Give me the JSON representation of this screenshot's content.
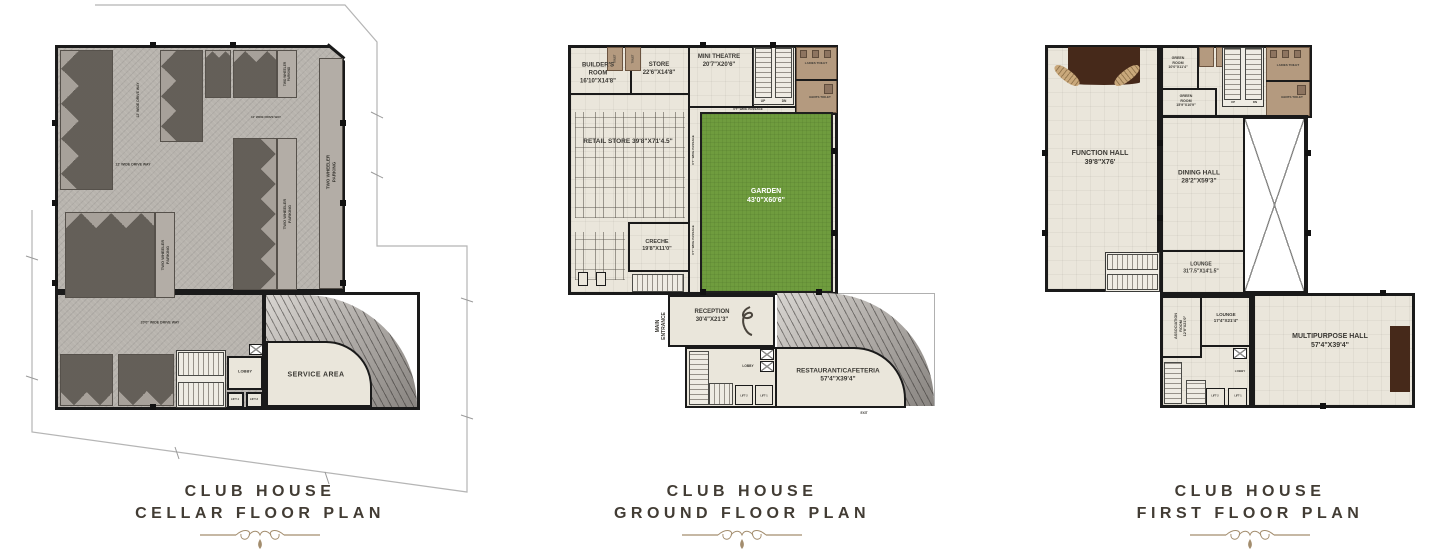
{
  "colors": {
    "garden_green": "#6f9c3e",
    "stage_brown": "#46291a",
    "toilet_tan": "#b49a7f",
    "wall_black": "#1a1a1a",
    "title_text": "#423c34",
    "ornament_tan": "#a38d6e"
  },
  "cellar": {
    "title1": "CLUB HOUSE",
    "title2": "CELLAR FLOOR PLAN",
    "labels": {
      "two_wheeler": "TWO WHEELER\nPARKING",
      "drive12": "12' WIDE DRIVE WAY",
      "drive20": "20'0\" WIDE DRIVE WAY",
      "service": "SERVICE AREA",
      "lobby": "LOBBY",
      "lift1": "LIFT-1",
      "lift2": "LIFT-2"
    }
  },
  "ground": {
    "title1": "CLUB HOUSE",
    "title2": "GROUND FLOOR PLAN",
    "rooms": {
      "builders": "BUILDER'S\nROOM\n16'10\"X14'8\"",
      "store": "STORE\n22'6\"X14'8\"",
      "mini_theatre": "MINI THEATRE\n20'7\"X20'6\"",
      "retail": "RETAIL STORE 39'8\"X71'4.5\"",
      "creche": "CRECHE\n19'8\"X11'0\"",
      "garden": "GARDEN\n43'0\"X60'6\"",
      "reception": "RECEPTION\n30'4\"X21'3\"",
      "restaurant": "RESTAURANT/CAFETERIA\n57'4\"X39'4\"",
      "main_entrance": "MAIN\nENTRANCE",
      "ladies": "LADIES TOILET",
      "gents": "GENTS TOILET",
      "toilet": "TOILET",
      "passage": "6'7\" WIDE PASSAGE",
      "lobby": "LOBBY",
      "lift1": "LIFT-1",
      "lift2": "LIFT-2",
      "up": "UP",
      "dn": "DN",
      "exit": "EXIT"
    }
  },
  "first": {
    "title1": "CLUB HOUSE",
    "title2": "FIRST FLOOR PLAN",
    "rooms": {
      "function_hall": "FUNCTION HALL\n39'8\"X76'",
      "green1": "GREEN\nROOM\n10'0\"X11'4\"",
      "green2": "GREEN\nROOM\n15'9\"X10'9\"",
      "dining": "DINING HALL\n28'2\"X59'3\"",
      "lounge1": "LOUNGE\n31'7.5\"X14'1.5\"",
      "association": "ASSOCIATION\nROOM\n12'8\"X21'0\"",
      "lounge2": "LOUNGE\n17'4\"X21'4\"",
      "multipurpose": "MULTIPURPOSE HALL\n57'4\"X39'4\"",
      "ladies": "LADIES TOILET",
      "gents": "GENTS TOILET",
      "lobby": "LOBBY",
      "lift1": "LIFT-1",
      "lift2": "LIFT-2",
      "up": "UP",
      "dn": "DN"
    }
  }
}
